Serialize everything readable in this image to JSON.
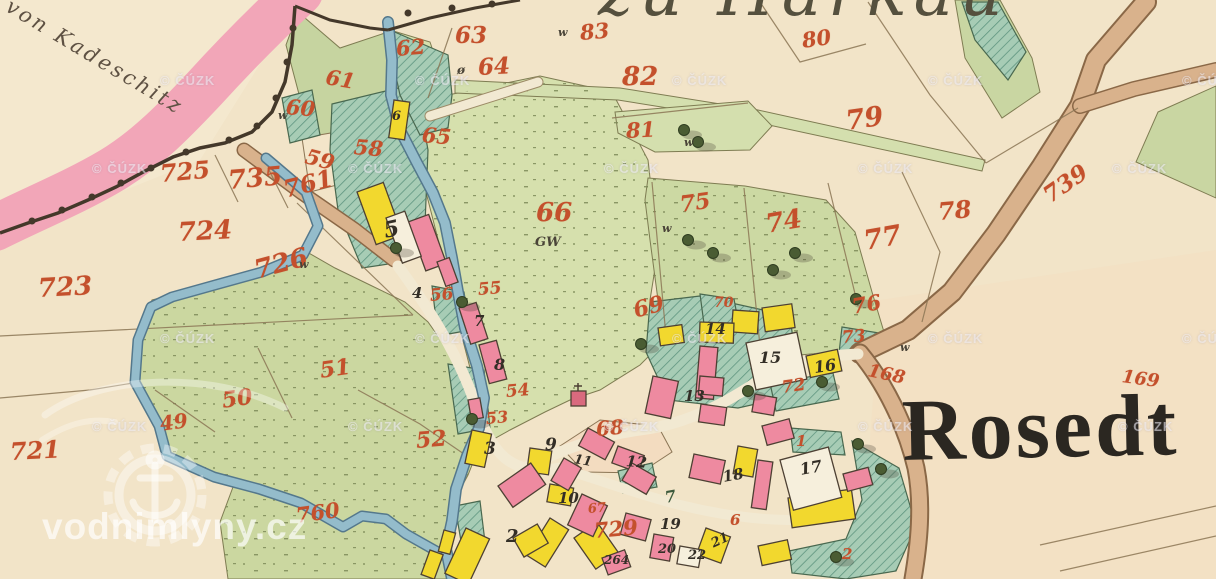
{
  "map": {
    "village_name": "Rosedt",
    "top_title": "zu Harkau",
    "neighbor_label": "von Kadeschitz"
  },
  "watermarks": {
    "cuzk": "© ČÚZK",
    "site": "vodnimlyny.cz",
    "cuzk_positions": [
      {
        "x": 160,
        "y": 74
      },
      {
        "x": 415,
        "y": 74
      },
      {
        "x": 672,
        "y": 74
      },
      {
        "x": 928,
        "y": 74
      },
      {
        "x": 1182,
        "y": 74
      },
      {
        "x": 92,
        "y": 162
      },
      {
        "x": 348,
        "y": 162
      },
      {
        "x": 604,
        "y": 162
      },
      {
        "x": 858,
        "y": 162
      },
      {
        "x": 1112,
        "y": 162
      },
      {
        "x": 160,
        "y": 332
      },
      {
        "x": 415,
        "y": 332
      },
      {
        "x": 672,
        "y": 332
      },
      {
        "x": 928,
        "y": 332
      },
      {
        "x": 1182,
        "y": 332
      },
      {
        "x": 92,
        "y": 420
      },
      {
        "x": 348,
        "y": 420
      },
      {
        "x": 604,
        "y": 420
      },
      {
        "x": 858,
        "y": 420
      },
      {
        "x": 1118,
        "y": 420
      }
    ]
  },
  "labels": {
    "red_parcels": [
      {
        "t": "725",
        "x": 160,
        "y": 162,
        "r": -5,
        "s": 24
      },
      {
        "t": "735",
        "x": 228,
        "y": 168,
        "r": -5,
        "s": 26
      },
      {
        "t": "761",
        "x": 284,
        "y": 178,
        "r": -14,
        "s": 24
      },
      {
        "t": "724",
        "x": 178,
        "y": 220,
        "r": -3,
        "s": 26
      },
      {
        "t": "726",
        "x": 255,
        "y": 258,
        "r": -15,
        "s": 26
      },
      {
        "t": "723",
        "x": 38,
        "y": 276,
        "r": -3,
        "s": 26
      },
      {
        "t": "721",
        "x": 10,
        "y": 440,
        "r": -3,
        "s": 24
      },
      {
        "t": "62",
        "x": 396,
        "y": 38,
        "r": -5
      },
      {
        "t": "63",
        "x": 455,
        "y": 24,
        "r": 0,
        "s": 23
      },
      {
        "t": "64",
        "x": 478,
        "y": 56,
        "r": -3,
        "s": 23
      },
      {
        "t": "61",
        "x": 326,
        "y": 66,
        "r": 10
      },
      {
        "t": "60",
        "x": 286,
        "y": 96,
        "r": 5
      },
      {
        "t": "59",
        "x": 306,
        "y": 145,
        "r": 15
      },
      {
        "t": "58",
        "x": 354,
        "y": 136,
        "r": 5
      },
      {
        "t": "65",
        "x": 422,
        "y": 124,
        "r": 5
      },
      {
        "t": "66",
        "x": 536,
        "y": 200,
        "r": 0,
        "s": 26
      },
      {
        "t": "83",
        "x": 580,
        "y": 22,
        "r": -5
      },
      {
        "t": "82",
        "x": 622,
        "y": 64,
        "r": 0,
        "s": 26
      },
      {
        "t": "81",
        "x": 626,
        "y": 120,
        "r": -3
      },
      {
        "t": "80",
        "x": 802,
        "y": 30,
        "r": -8
      },
      {
        "t": "79",
        "x": 846,
        "y": 108,
        "r": -8,
        "s": 27
      },
      {
        "t": "78",
        "x": 938,
        "y": 200,
        "r": -5,
        "s": 24
      },
      {
        "t": "77",
        "x": 864,
        "y": 228,
        "r": -10,
        "s": 27
      },
      {
        "t": "75",
        "x": 680,
        "y": 194,
        "r": -8,
        "s": 22
      },
      {
        "t": "74",
        "x": 766,
        "y": 212,
        "r": -10,
        "s": 26
      },
      {
        "t": "76",
        "x": 852,
        "y": 296,
        "r": -10
      },
      {
        "t": "70",
        "x": 714,
        "y": 296,
        "r": 0,
        "s": 14
      },
      {
        "t": "69",
        "x": 634,
        "y": 300,
        "r": -15,
        "s": 22
      },
      {
        "t": "73",
        "x": 842,
        "y": 330,
        "r": -5,
        "s": 17
      },
      {
        "t": "72",
        "x": 782,
        "y": 380,
        "r": -8,
        "s": 17
      },
      {
        "t": "168",
        "x": 868,
        "y": 362,
        "r": 12,
        "s": 18
      },
      {
        "t": "169",
        "x": 1122,
        "y": 368,
        "r": 8,
        "s": 18
      },
      {
        "t": "739",
        "x": 1046,
        "y": 186,
        "r": -35,
        "s": 23
      },
      {
        "t": "55",
        "x": 478,
        "y": 282,
        "r": -5,
        "s": 17
      },
      {
        "t": "56",
        "x": 430,
        "y": 288,
        "r": -5,
        "s": 17
      },
      {
        "t": "54",
        "x": 506,
        "y": 384,
        "r": -5,
        "s": 17
      },
      {
        "t": "53",
        "x": 486,
        "y": 411,
        "r": -5,
        "s": 16
      },
      {
        "t": "52",
        "x": 416,
        "y": 430,
        "r": -5,
        "s": 22
      },
      {
        "t": "51",
        "x": 320,
        "y": 360,
        "r": -8,
        "s": 22
      },
      {
        "t": "50",
        "x": 222,
        "y": 390,
        "r": -8,
        "s": 22
      },
      {
        "t": "49",
        "x": 160,
        "y": 414,
        "r": -8,
        "s": 20
      },
      {
        "t": "760",
        "x": 296,
        "y": 505,
        "r": -8,
        "s": 21
      },
      {
        "t": "729",
        "x": 594,
        "y": 520,
        "r": -5,
        "s": 21
      },
      {
        "t": "68",
        "x": 596,
        "y": 419,
        "r": -5,
        "s": 20
      },
      {
        "t": "67",
        "x": 588,
        "y": 503,
        "r": -5,
        "s": 13
      },
      {
        "t": "1",
        "x": 796,
        "y": 434,
        "r": 0,
        "s": 15
      },
      {
        "t": "2",
        "x": 842,
        "y": 547,
        "r": 0,
        "s": 15
      },
      {
        "t": "6",
        "x": 730,
        "y": 513,
        "r": 0,
        "s": 15
      }
    ],
    "black_buildings": [
      {
        "t": "6",
        "x": 392,
        "y": 110,
        "s": 13
      },
      {
        "t": "5",
        "x": 384,
        "y": 220,
        "s": 22,
        "r": -12
      },
      {
        "t": "4",
        "x": 412,
        "y": 286
      },
      {
        "t": "7",
        "x": 474,
        "y": 314
      },
      {
        "t": "8",
        "x": 494,
        "y": 357,
        "s": 16
      },
      {
        "t": "3",
        "x": 484,
        "y": 441,
        "s": 17
      },
      {
        "t": "9",
        "x": 545,
        "y": 437,
        "s": 17
      },
      {
        "t": "11",
        "x": 574,
        "y": 453,
        "s": 13,
        "r": 10
      },
      {
        "t": "12",
        "x": 626,
        "y": 454,
        "r": 5
      },
      {
        "t": "10",
        "x": 558,
        "y": 491
      },
      {
        "t": "2",
        "x": 506,
        "y": 528,
        "s": 18
      },
      {
        "t": "19",
        "x": 660,
        "y": 517
      },
      {
        "t": "20",
        "x": 658,
        "y": 543,
        "s": 13
      },
      {
        "t": "22",
        "x": 688,
        "y": 549,
        "s": 13
      },
      {
        "t": "21",
        "x": 712,
        "y": 538,
        "s": 13,
        "r": -25
      },
      {
        "t": "18",
        "x": 723,
        "y": 470,
        "r": -10
      },
      {
        "t": "13",
        "x": 684,
        "y": 389
      },
      {
        "t": "14",
        "x": 705,
        "y": 322
      },
      {
        "t": "15",
        "x": 759,
        "y": 350,
        "s": 16
      },
      {
        "t": "16",
        "x": 814,
        "y": 360,
        "s": 16,
        "r": -8
      },
      {
        "t": "17",
        "x": 800,
        "y": 462,
        "s": 16,
        "r": -10
      },
      {
        "t": "264",
        "x": 604,
        "y": 554,
        "s": 12
      },
      {
        "t": "7",
        "x": 665,
        "y": 490,
        "s": 16,
        "r": -10,
        "c": "grn"
      }
    ],
    "small_marks": [
      {
        "t": "GW",
        "x": 535,
        "y": 236,
        "s": 13
      },
      {
        "t": "w",
        "x": 558,
        "y": 27
      },
      {
        "t": "w",
        "x": 684,
        "y": 137
      },
      {
        "t": "w",
        "x": 662,
        "y": 223
      },
      {
        "t": "w",
        "x": 278,
        "y": 110
      },
      {
        "t": "w",
        "x": 299,
        "y": 259
      },
      {
        "t": "w",
        "x": 900,
        "y": 342
      },
      {
        "t": "ø",
        "x": 457,
        "y": 64,
        "s": 12
      }
    ]
  },
  "colors": {
    "paper": "#f2e4c8",
    "pink_border": "#f2a6b8",
    "meadow_green": "#cdd9a2",
    "garden_teal": "#a7ccb5",
    "stream_blue": "#94bccb",
    "road_tan": "#d9b28c",
    "building_pink": "#ee8aa0",
    "building_yellow": "#f2d82e",
    "red_number": "#c4502c",
    "ink": "#332e26"
  }
}
